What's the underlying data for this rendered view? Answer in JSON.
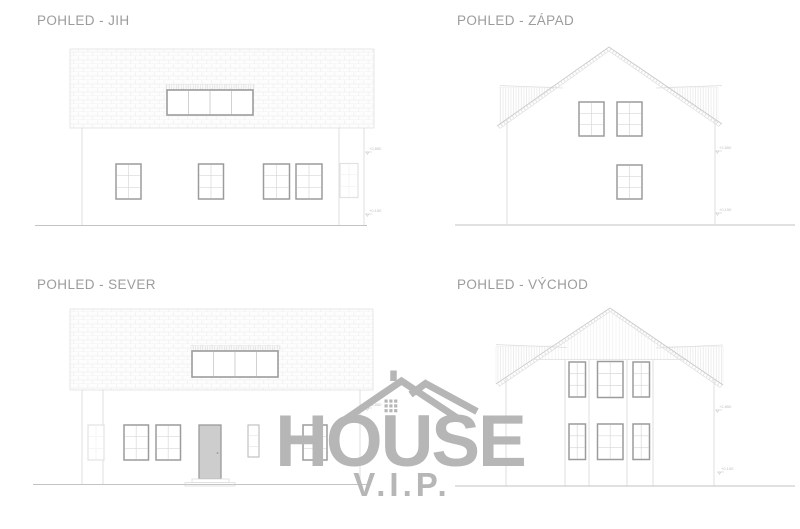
{
  "sheet": {
    "background": "#ffffff"
  },
  "views": {
    "jih": {
      "title": "POHLED - JIH",
      "markers": [
        {
          "label": "+2,850"
        },
        {
          "label": "+0,150"
        }
      ]
    },
    "zapad": {
      "title": "POHLED - ZÁPAD",
      "markers": [
        {
          "label": "+2,850"
        },
        {
          "label": "+0,150"
        }
      ]
    },
    "sever": {
      "title": "POHLED - SEVER",
      "markers": [
        {
          "label": "+2,850"
        }
      ]
    },
    "vychod": {
      "title": "POHLED - VÝCHOD",
      "markers": [
        {
          "label": "+2,850"
        },
        {
          "label": "+0,150"
        }
      ]
    }
  },
  "watermark": {
    "brand": "HOUSE",
    "sub_brand": "V.I.P.",
    "color": "#b6b6b6"
  },
  "colors": {
    "title_text": "#9c9c9c",
    "wall_line": "#dcdcdc",
    "window_frame": "#9c9c9c",
    "ground_line": "#c3c3c3",
    "roof_tile_line": "#f0f0f0",
    "door_fill": "#cdcdcd",
    "watermark_gray": "#b6b6b6"
  }
}
